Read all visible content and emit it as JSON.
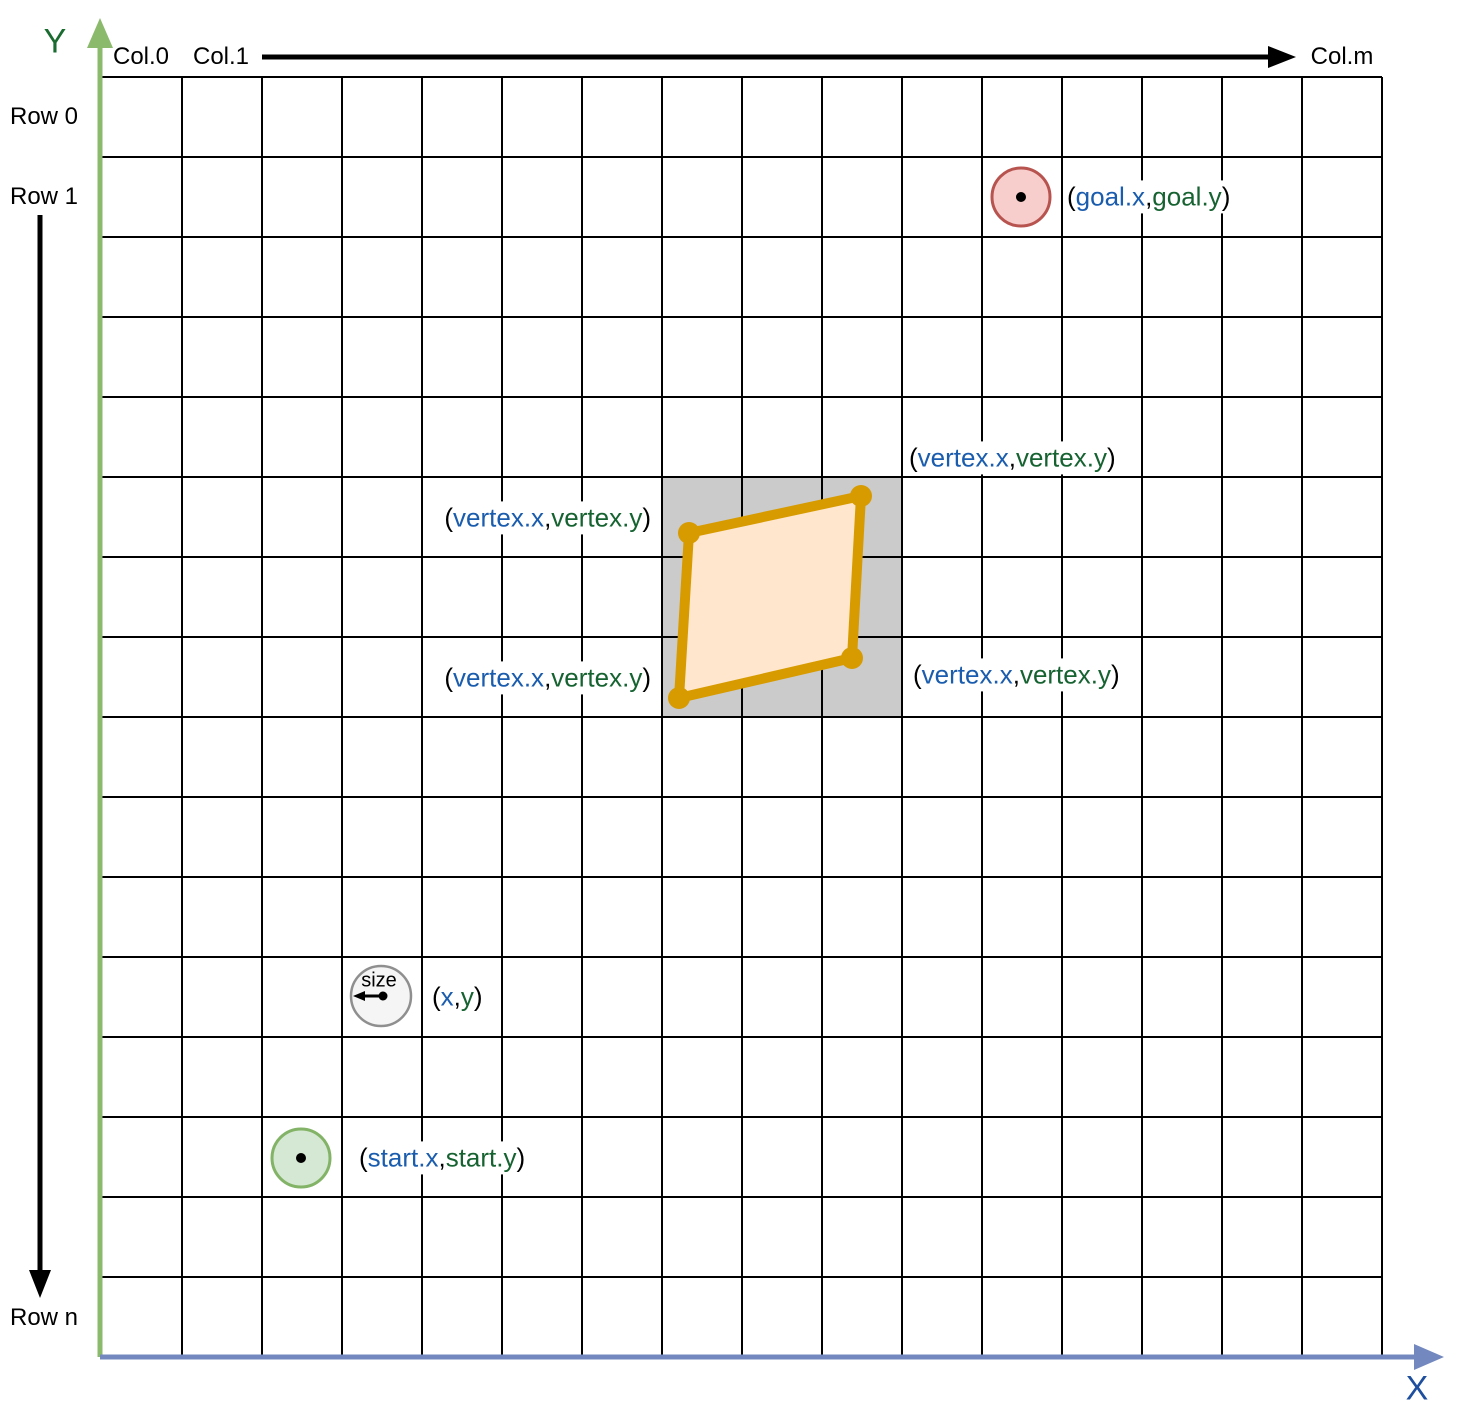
{
  "axes": {
    "y_label": "Y",
    "x_label": "X",
    "col0": "Col.0",
    "col1": "Col.1",
    "colm": "Col.m",
    "row0": "Row 0",
    "row1": "Row 1",
    "rown": "Row n"
  },
  "grid": {
    "cols": 16,
    "rows": 16
  },
  "punct": {
    "open": "(",
    "comma": ",",
    "close": ")"
  },
  "goal": {
    "x_part": "goal.x",
    "y_part": "goal.y"
  },
  "start": {
    "x_part": "start.x",
    "y_part": "start.y"
  },
  "robot": {
    "size_label": "size",
    "x_part": "x",
    "y_part": "y"
  },
  "obstacle": {
    "vertex_labels": [
      {
        "x_part": "vertex.x",
        "y_part": "vertex.y"
      },
      {
        "x_part": "vertex.x",
        "y_part": "vertex.y"
      },
      {
        "x_part": "vertex.x",
        "y_part": "vertex.y"
      },
      {
        "x_part": "vertex.x",
        "y_part": "vertex.y"
      }
    ]
  },
  "colors": {
    "grid_line": "#000000",
    "coord_x_text": "#1A5CAD",
    "coord_y_text": "#166331",
    "y_axis": "#8CBA6D",
    "y_axis_label": "#1A6B30",
    "x_axis": "#7388BE",
    "x_axis_label": "#1E4F9F",
    "occupied_cells_fill": "#CBCBCB",
    "obstacle_fill": "#FFE6CC",
    "obstacle_stroke": "#D79B00",
    "goal_fill": "#F8CECC",
    "goal_stroke": "#B85450",
    "start_fill": "#D5E8D4",
    "start_stroke": "#82B366",
    "robot_fill": "#F5F5F5",
    "robot_stroke": "#8F8F8F",
    "annotation_arrow": "#000000"
  }
}
